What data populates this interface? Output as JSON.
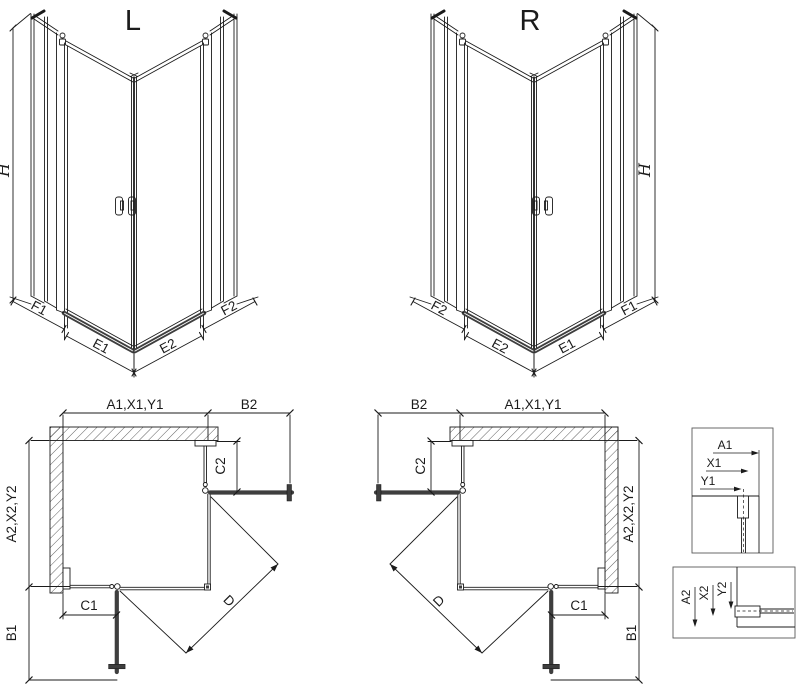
{
  "l_view": {
    "title": "L",
    "height_label": "H",
    "dim_f1": "F1",
    "dim_e1": "E1",
    "dim_e2": "E2",
    "dim_f2": "F2"
  },
  "r_view": {
    "title": "R",
    "height_label": "H",
    "dim_f1": "F1",
    "dim_e1": "E1",
    "dim_e2": "E2",
    "dim_f2": "F2"
  },
  "l_plan": {
    "dim_width": "A1,X1,Y1",
    "dim_b2": "B2",
    "dim_c2": "C2",
    "dim_depth": "A2,X2,Y2",
    "dim_c1": "C1",
    "dim_b1": "B1",
    "dim_d": "D"
  },
  "r_plan": {
    "dim_width": "A1,X1,Y1",
    "dim_b2": "B2",
    "dim_c2": "C2",
    "dim_depth": "A2,X2,Y2",
    "dim_c1": "C1",
    "dim_b1": "B1",
    "dim_d": "D"
  },
  "detail_top": {
    "dim_a1": "A1",
    "dim_x1": "X1",
    "dim_y1": "Y1"
  },
  "detail_bottom": {
    "dim_a2": "A2",
    "dim_x2": "X2",
    "dim_y2": "Y2"
  },
  "colors": {
    "line": "#1b1b1b",
    "door_bar": "#3e3e3e",
    "background": "#ffffff"
  }
}
